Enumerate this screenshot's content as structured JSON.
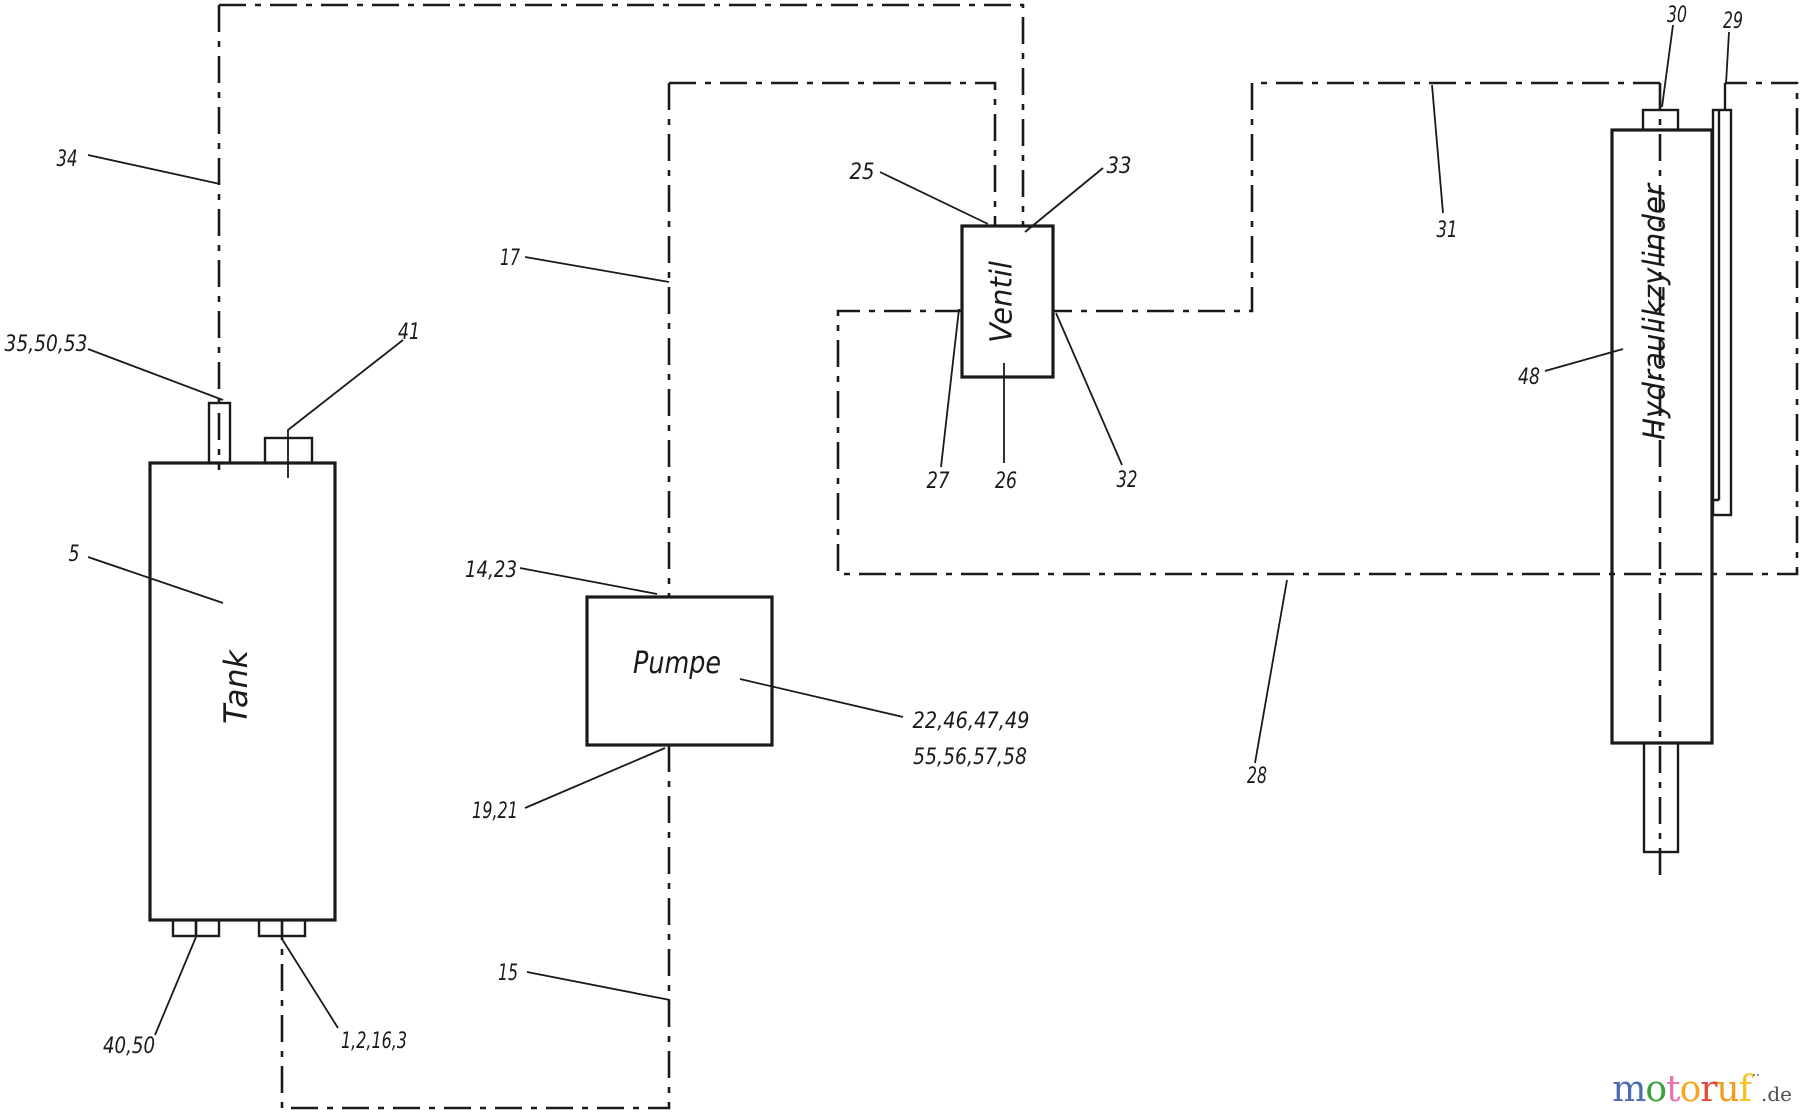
{
  "components": {
    "tank": "Tank",
    "pump": "Pumpe",
    "valve": "Ventil",
    "cylinder": "Hydraulikzylinder"
  },
  "labels": {
    "l34": "34",
    "l35_50_53": "35,50,53",
    "l41": "41",
    "l5": "5",
    "l40_50": "40,50",
    "l1_2_16_3": "1,2,16,3",
    "l15": "15",
    "l17": "17",
    "l14_23": "14,23",
    "l19_21": "19,21",
    "l22_46_47_49": "22,46,47,49",
    "l55_56_57_58": "55,56,57,58",
    "l25": "25",
    "l33": "33",
    "l27": "27",
    "l26": "26",
    "l32": "32",
    "l31": "31",
    "l28": "28",
    "l30": "30",
    "l29": "29",
    "l48": "48"
  },
  "watermark": {
    "letters": [
      {
        "ch": "m",
        "color": "#4a6cb3"
      },
      {
        "ch": "o",
        "color": "#3aa23a"
      },
      {
        "ch": "t",
        "color": "#e873ae"
      },
      {
        "ch": "o",
        "color": "#f2a71f"
      },
      {
        "ch": "r",
        "color": "#e14a34"
      },
      {
        "ch": "u",
        "color": "#ef9d1f"
      },
      {
        "ch": "f",
        "color": "#f6c21f"
      }
    ],
    "mark": "¨",
    "suffix": ".de"
  },
  "colors": {
    "line": "#1a1a1a",
    "background": "#ffffff"
  }
}
